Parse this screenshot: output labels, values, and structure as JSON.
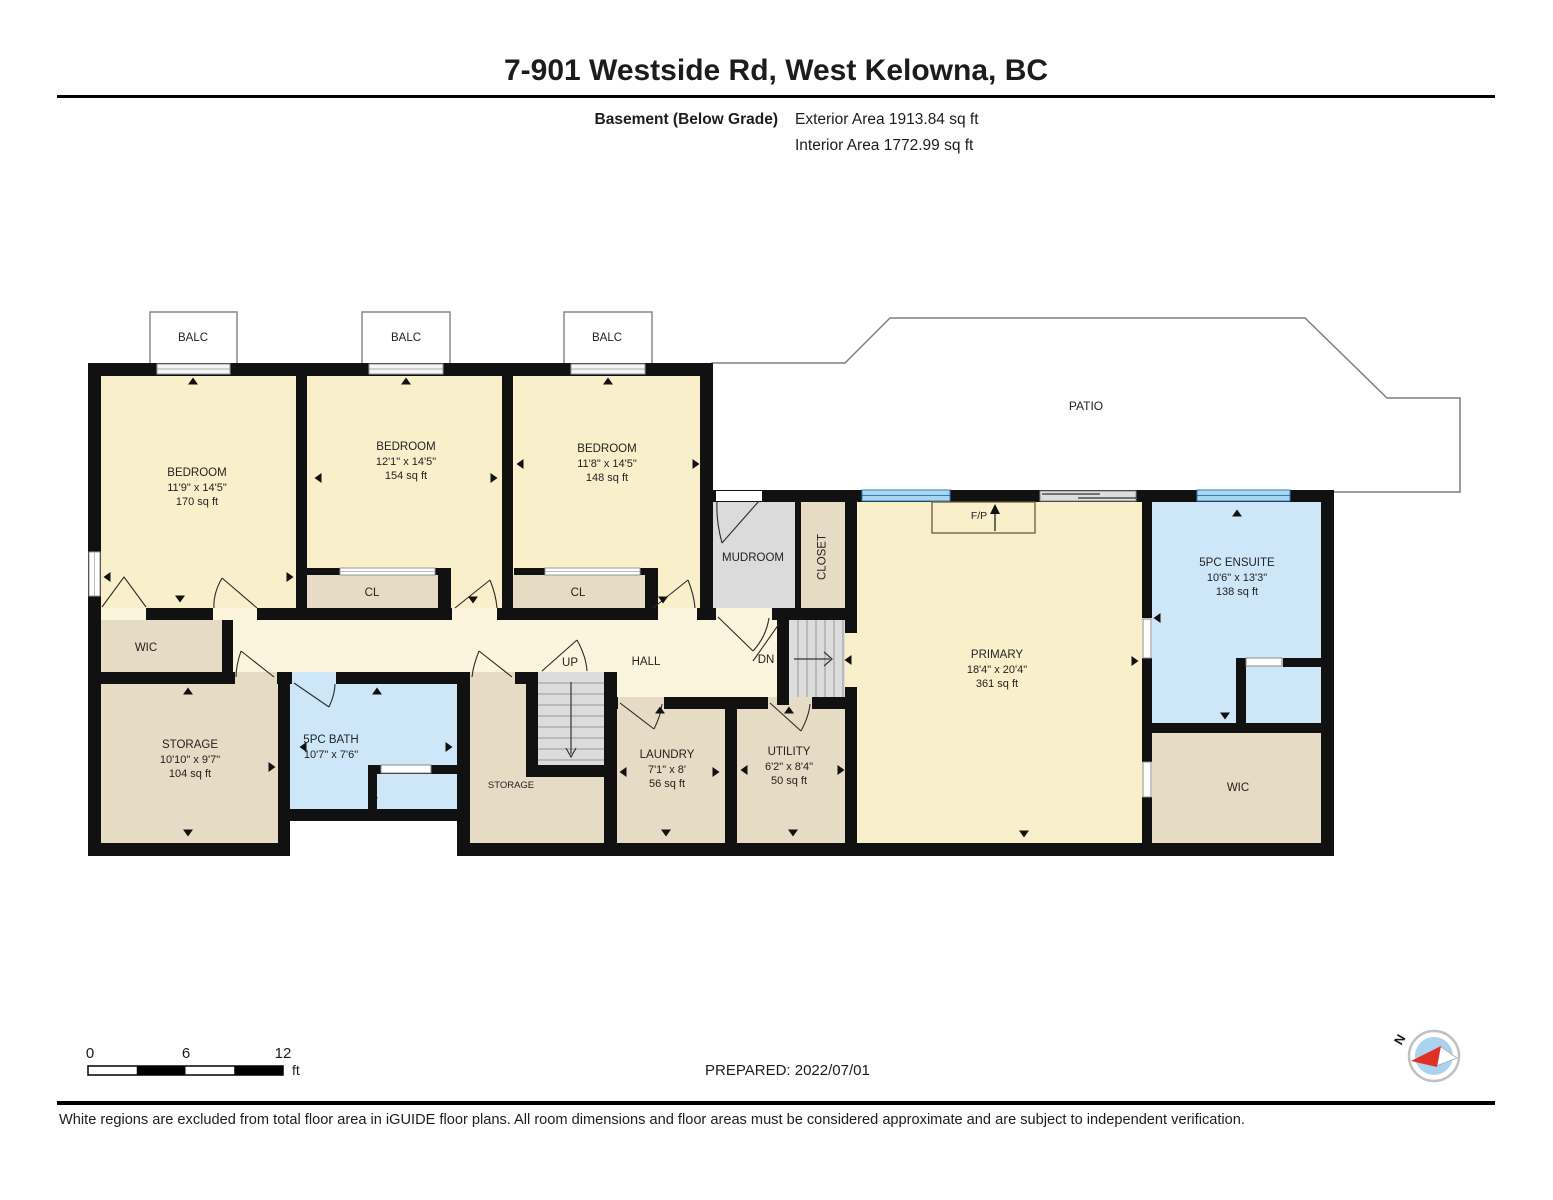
{
  "header": {
    "title": "7-901 Westside Rd, West Kelowna, BC",
    "floor_label": "Basement (Below Grade)",
    "exterior_area": "Exterior Area 1913.84 sq ft",
    "interior_area": "Interior Area 1772.99 sq ft"
  },
  "rooms": {
    "balc1": {
      "label": "BALC"
    },
    "balc2": {
      "label": "BALC"
    },
    "balc3": {
      "label": "BALC"
    },
    "bedroom1": {
      "name": "BEDROOM",
      "dims": "11'9\" x 14'5\"",
      "area": "170 sq ft"
    },
    "bedroom2": {
      "name": "BEDROOM",
      "dims": "12'1\" x 14'5\"",
      "area": "154 sq ft"
    },
    "bedroom3": {
      "name": "BEDROOM",
      "dims": "11'8\" x 14'5\"",
      "area": "148 sq ft"
    },
    "cl1": {
      "label": "CL"
    },
    "cl2": {
      "label": "CL"
    },
    "mudroom": {
      "label": "MUDROOM"
    },
    "closet": {
      "label": "CLOSET"
    },
    "patio": {
      "label": "PATIO"
    },
    "fireplace": {
      "label": "F/P"
    },
    "primary": {
      "name": "PRIMARY",
      "dims": "18'4\" x 20'4\"",
      "area": "361 sq ft"
    },
    "ensuite": {
      "name": "5PC ENSUITE",
      "dims": "10'6\" x 13'3\"",
      "area": "138 sq ft"
    },
    "wic_right": {
      "label": "WIC"
    },
    "wic_left": {
      "label": "WIC"
    },
    "storage1": {
      "name": "STORAGE",
      "dims": "10'10\" x 9'7\"",
      "area": "104 sq ft"
    },
    "bath": {
      "name": "5PC BATH",
      "dims": "10'7\" x 7'6\""
    },
    "storage2": {
      "label": "STORAGE"
    },
    "hall": {
      "label": "HALL"
    },
    "up": {
      "label": "UP"
    },
    "dn": {
      "label": "DN"
    },
    "laundry": {
      "name": "LAUNDRY",
      "dims": "7'1\" x 8'",
      "area": "56 sq ft"
    },
    "utility": {
      "name": "UTILITY",
      "dims": "6'2\" x 8'4\"",
      "area": "50 sq ft"
    }
  },
  "footer": {
    "scale_start": "0",
    "scale_mid": "6",
    "scale_end": "12",
    "scale_unit": "ft",
    "prepared": "PREPARED: 2022/07/01",
    "compass_north": "N",
    "disclaimer": "White regions are excluded from total floor area in iGUIDE floor plans. All room dimensions and floor areas must be considered approximate and are subject to independent verification."
  },
  "colors": {
    "room_yellow": "#FAEFCB",
    "hall_yellow": "#FCF5DE",
    "tan": "#E6DBC4",
    "blue_room": "#CDE7F8",
    "gray_room": "#DBDBDB",
    "wall": "#111111",
    "window_blue": "#A9D6EF",
    "window_line": "#2E7CB7",
    "compass_red": "#E03127"
  }
}
